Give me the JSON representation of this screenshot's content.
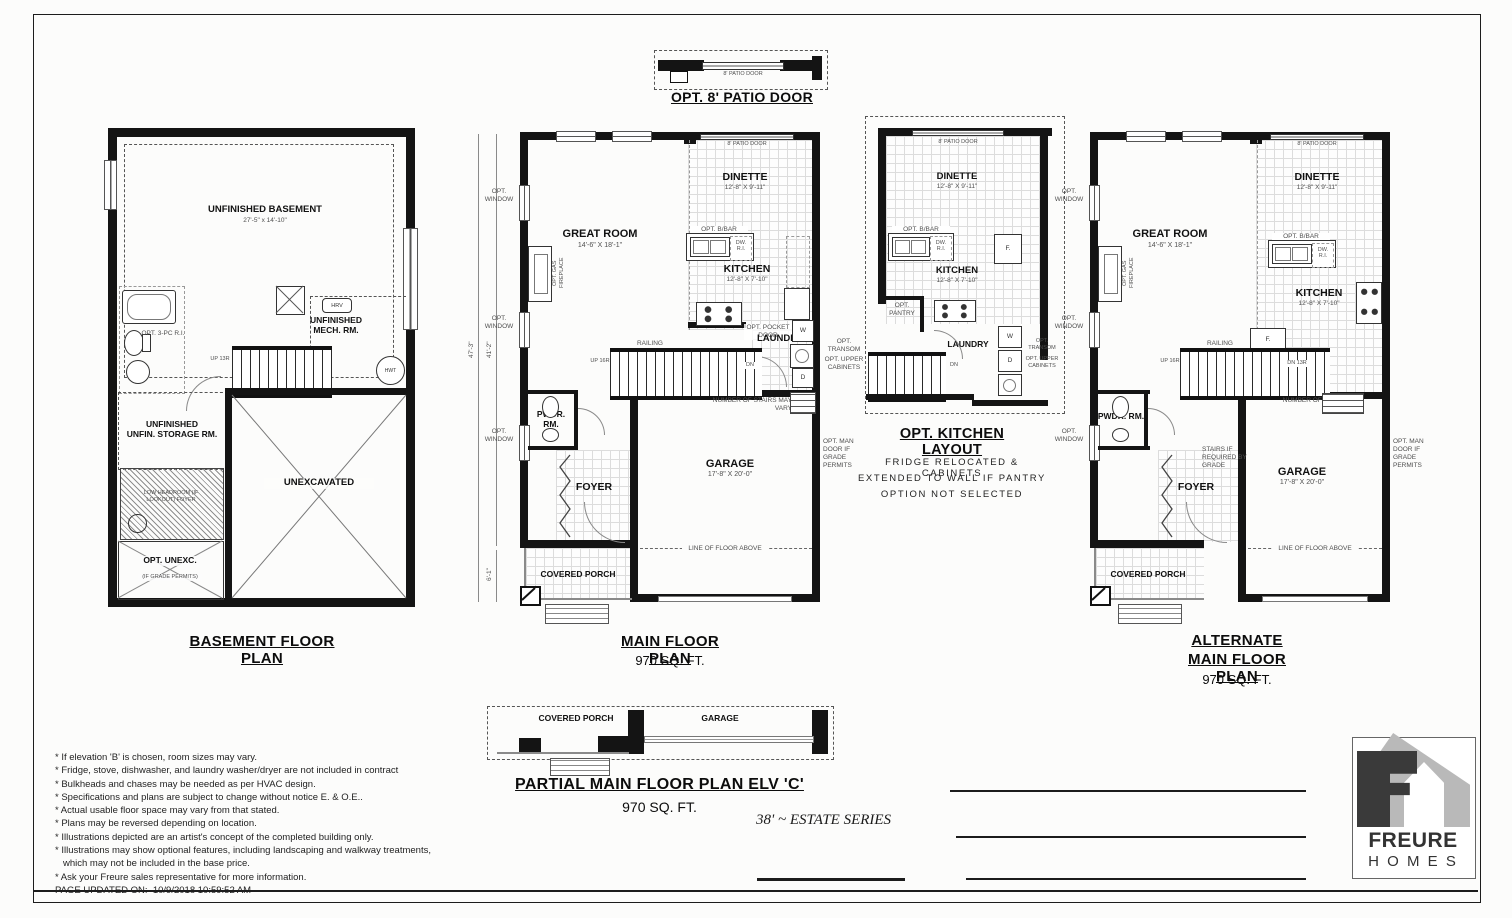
{
  "doc": {
    "patio_detail": {
      "title": "OPT. 8' PATIO DOOR"
    },
    "labels": {
      "patio_door": "8' PATIO DOOR",
      "opt_window": "OPT. WINDOW",
      "railing": "RAILING",
      "up13": "UP 13R",
      "up16": "UP 16R",
      "dn": "DN",
      "dn13": "DN 13R",
      "stairs_vary": "NUMBER OF STAIRS MAY VARY",
      "opt_transom": "OPT. TRANSOM",
      "opt_upper_cab": "OPT. UPPER CABINETS",
      "opt_pocket_door": "OPT. POCKET DOOR",
      "opt_bbar": "OPT. B/BAR",
      "dw_ri": "DW. R.I.",
      "washer": "W",
      "dryer": "D",
      "fridge": "F.",
      "opt_pantry": "OPT. PANTRY",
      "opt_gas_fireplace": "OPT. GAS FIREPLACE",
      "opt_man_door": "OPT. MAN DOOR IF GRADE PERMITS",
      "stairs_grade": "STAIRS IF REQUIRED BY GRADE",
      "line_floor_above": "LINE OF FLOOR ABOVE",
      "covered_porch": "COVERED PORCH",
      "hrv": "HRV",
      "hwt": "HWT"
    },
    "rooms": {
      "great": "GREAT ROOM",
      "great_dim": "14'-6\" X 18'-1\"",
      "dinette": "DINETTE",
      "dinette_dim": "12'-8\" X 9'-11\"",
      "kitchen": "KITCHEN",
      "kitchen_dim": "12'-8\" X 7'-10\"",
      "laundry": "LAUNDRY",
      "pwdr": "PWDR. RM.",
      "foyer": "FOYER",
      "garage": "GARAGE",
      "garage_dim": "17'-8\" X 20'-0\""
    },
    "dims": {
      "h47": "47'-3\"",
      "h41": "41'-2\"",
      "h6": "6'-1\""
    },
    "basement": {
      "title": "BASEMENT FLOOR PLAN",
      "name": "UNFINISHED BASEMENT",
      "dim": "27'-5\" x 14'-10\"",
      "mech": "UNFINISHED MECH. RM.",
      "storage1": "UNFINISHED",
      "storage2": "UNFIN. STORAGE RM.",
      "unexc": "UNEXCAVATED",
      "opt_unexc": "OPT. UNEXC.",
      "opt_unexc_sub": "(IF GRADE PERMITS)",
      "opt_3pc": "OPT. 3-PC R.I.",
      "low_headroom": "LOW HEADROOM (IF LOOKOUT) FOYER"
    },
    "main": {
      "title": "MAIN FLOOR PLAN",
      "sqft": "970 SQ. FT."
    },
    "opt_kitchen": {
      "title": "OPT. KITCHEN LAYOUT",
      "caption": [
        "FRIDGE RELOCATED & CABINETS",
        "EXTENDED TO WALL IF PANTRY",
        "OPTION NOT SELECTED"
      ]
    },
    "alternate": {
      "title1": "ALTERNATE",
      "title2": "MAIN FLOOR PLAN",
      "sqft": "970 SQ. FT."
    },
    "partial": {
      "title": "PARTIAL MAIN FLOOR PLAN ELV 'C'",
      "sqft": "970 SQ. FT."
    },
    "series": "38' ~ ESTATE SERIES",
    "notes": [
      "* If elevation 'B' is chosen, room sizes may vary.",
      "* Fridge, stove, dishwasher, and laundry washer/dryer are not included in contract",
      "* Bulkheads and chases may be needed as per HVAC design.",
      "* Specifications and plans are subject to change without notice E. & O.E..",
      "* Actual usable floor space may vary from that stated.",
      "* Plans may be reversed depending on location.",
      "* Illustrations depicted are an artist's concept of the completed building only.",
      "* Illustrations may show optional features, including landscaping and walkway treatments,",
      "which may not be included in the base price.",
      "* Ask your Freure sales representative for more information."
    ],
    "page_updated_label": "PAGE UPDATED ON:",
    "page_updated_value": "10/9/2018 10:59:52 AM",
    "logo": {
      "brand": "FREURE",
      "sub": "H O M E S"
    }
  }
}
